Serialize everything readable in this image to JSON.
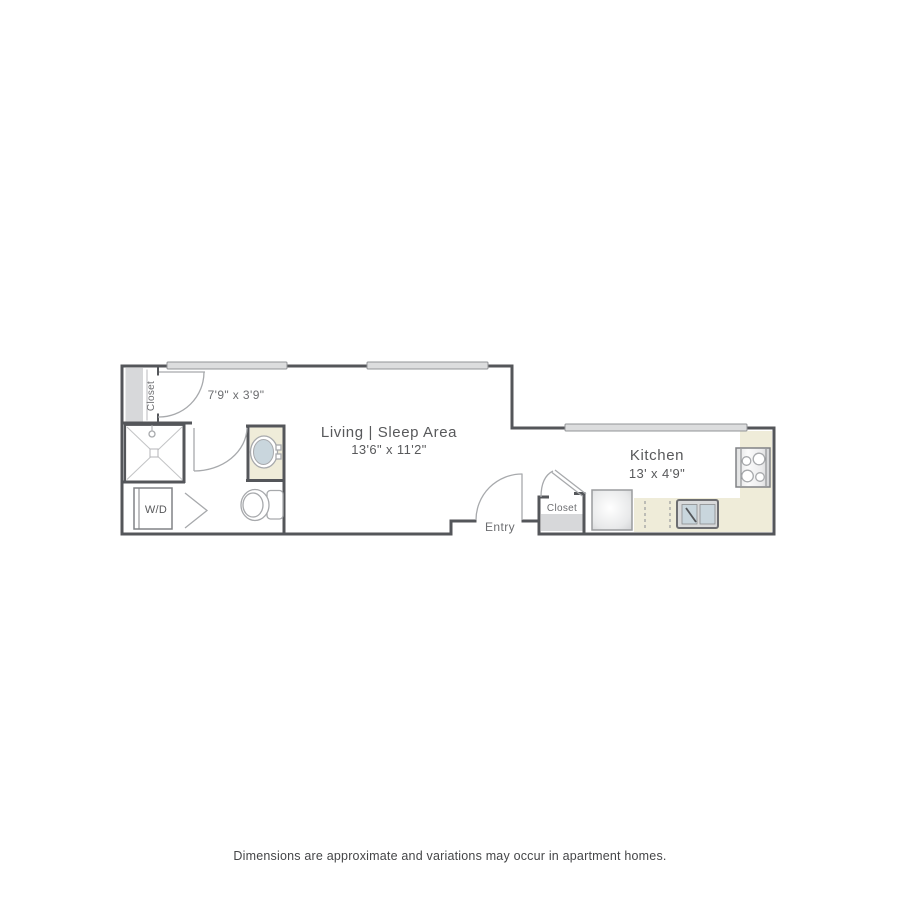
{
  "floorplan": {
    "living": {
      "name": "Living | Sleep Area",
      "dimensions": "13'6\" x 11'2\""
    },
    "kitchen": {
      "name": "Kitchen",
      "dimensions": "13' x 4'9\""
    },
    "bathroom": {
      "dimensions": "7'9\" x 3'9\""
    },
    "closet_left": {
      "label": "Closet"
    },
    "closet_entry": {
      "label": "Closet"
    },
    "entry": {
      "label": "Entry"
    },
    "washer_dryer": {
      "label": "W/D"
    },
    "colors": {
      "wall": "#54565a",
      "fixture_line": "#a7a9ac",
      "counter": "#efecd9",
      "light_gray_fill": "#d7d8da",
      "window_fill": "#dcddde",
      "basin": "#c9d6dd",
      "label_text": "#6d6e71",
      "room_text": "#58595b"
    }
  },
  "footer": {
    "disclaimer": "Dimensions are approximate and variations may occur in apartment homes."
  }
}
